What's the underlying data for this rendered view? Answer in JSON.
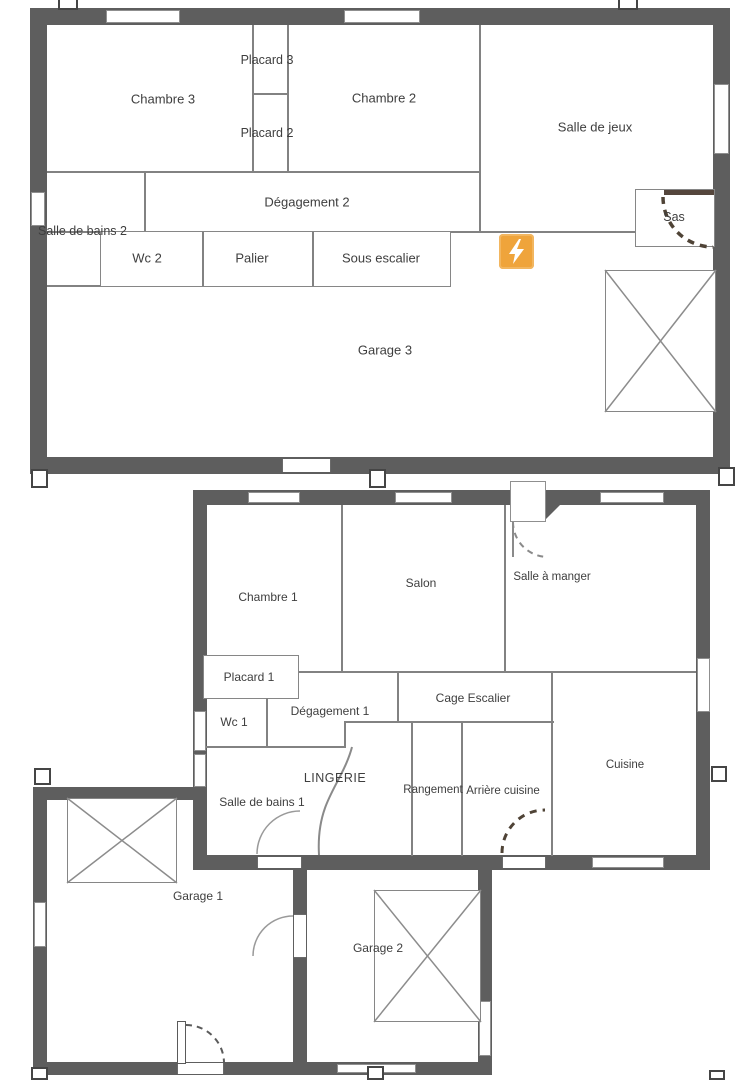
{
  "plan": {
    "type": "house-floor-plan",
    "upper_floor": {
      "rooms": {
        "chambre3": "Chambre 3",
        "placard3": "Placard 3",
        "placard2": "Placard 2",
        "chambre2": "Chambre 2",
        "salle_de_jeux": "Salle de jeux",
        "degagement2": "Dégagement 2",
        "salle_de_bains2": "Salle de bains 2",
        "wc2": "Wc 2",
        "palier": "Palier",
        "sous_escalier": "Sous escalier",
        "sas": "Sas",
        "garage3": "Garage 3"
      }
    },
    "ground_floor": {
      "rooms": {
        "chambre1": "Chambre 1",
        "salon": "Salon",
        "salle_a_manger": "Salle à manger",
        "placard1": "Placard 1",
        "wc1": "Wc 1",
        "degagement1": "Dégagement 1",
        "cage_escalier": "Cage Escalier",
        "lingerie": "LINGERIE",
        "salle_de_bains1": "Salle de bains 1",
        "rangement": "Rangement",
        "arriere_cuisine": "Arrière cuisine",
        "cuisine": "Cuisine",
        "garage1": "Garage 1",
        "garage2": "Garage 2"
      }
    },
    "icons": {
      "electric_marker": "lightning-icon",
      "selection_handle": "square-handle-icon",
      "garage_opening": "crossed-box-symbol",
      "door": "door-arc-symbol",
      "window": "window-symbol"
    },
    "colors": {
      "wall": "#5e5e5e",
      "partition": "#828282",
      "text": "#3e3e3e",
      "electric_bg": "#efa43b",
      "door_dash": "#4f4336"
    }
  }
}
